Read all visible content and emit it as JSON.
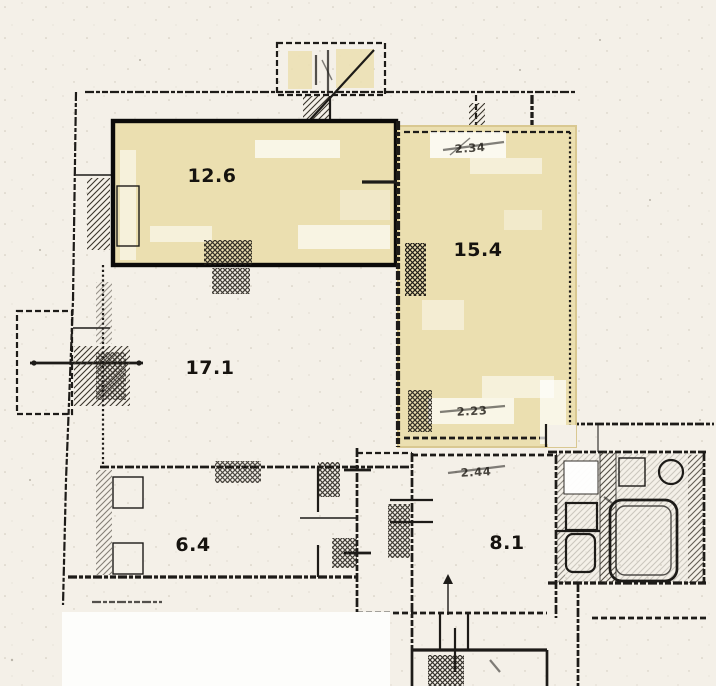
{
  "plan": {
    "rooms": [
      {
        "name": "room-12-6",
        "area_label": "12.6",
        "highlighted": true
      },
      {
        "name": "room-15-4",
        "area_label": "15.4",
        "highlighted": true
      },
      {
        "name": "room-17-1",
        "area_label": "17.1",
        "highlighted": false
      },
      {
        "name": "room-6-4",
        "area_label": "6.4",
        "highlighted": false
      },
      {
        "name": "room-8-1",
        "area_label": "8.1",
        "highlighted": false
      }
    ],
    "dimension_marks": [
      {
        "name": "dim-room-15-4-top",
        "label": "2.34"
      },
      {
        "name": "dim-room-15-4-bottom",
        "label": "2.23"
      },
      {
        "name": "dim-room-8-1-top",
        "label": "2.44"
      }
    ],
    "fixtures": [
      "bathtub",
      "toilet",
      "sink"
    ],
    "colors": {
      "paper": "#f4f0e8",
      "highlight_fill": "#ebdfb0",
      "highlight_border": "#d9c891",
      "wall_ink": "#1d1b18",
      "void_white": "#fdfdfb"
    }
  }
}
